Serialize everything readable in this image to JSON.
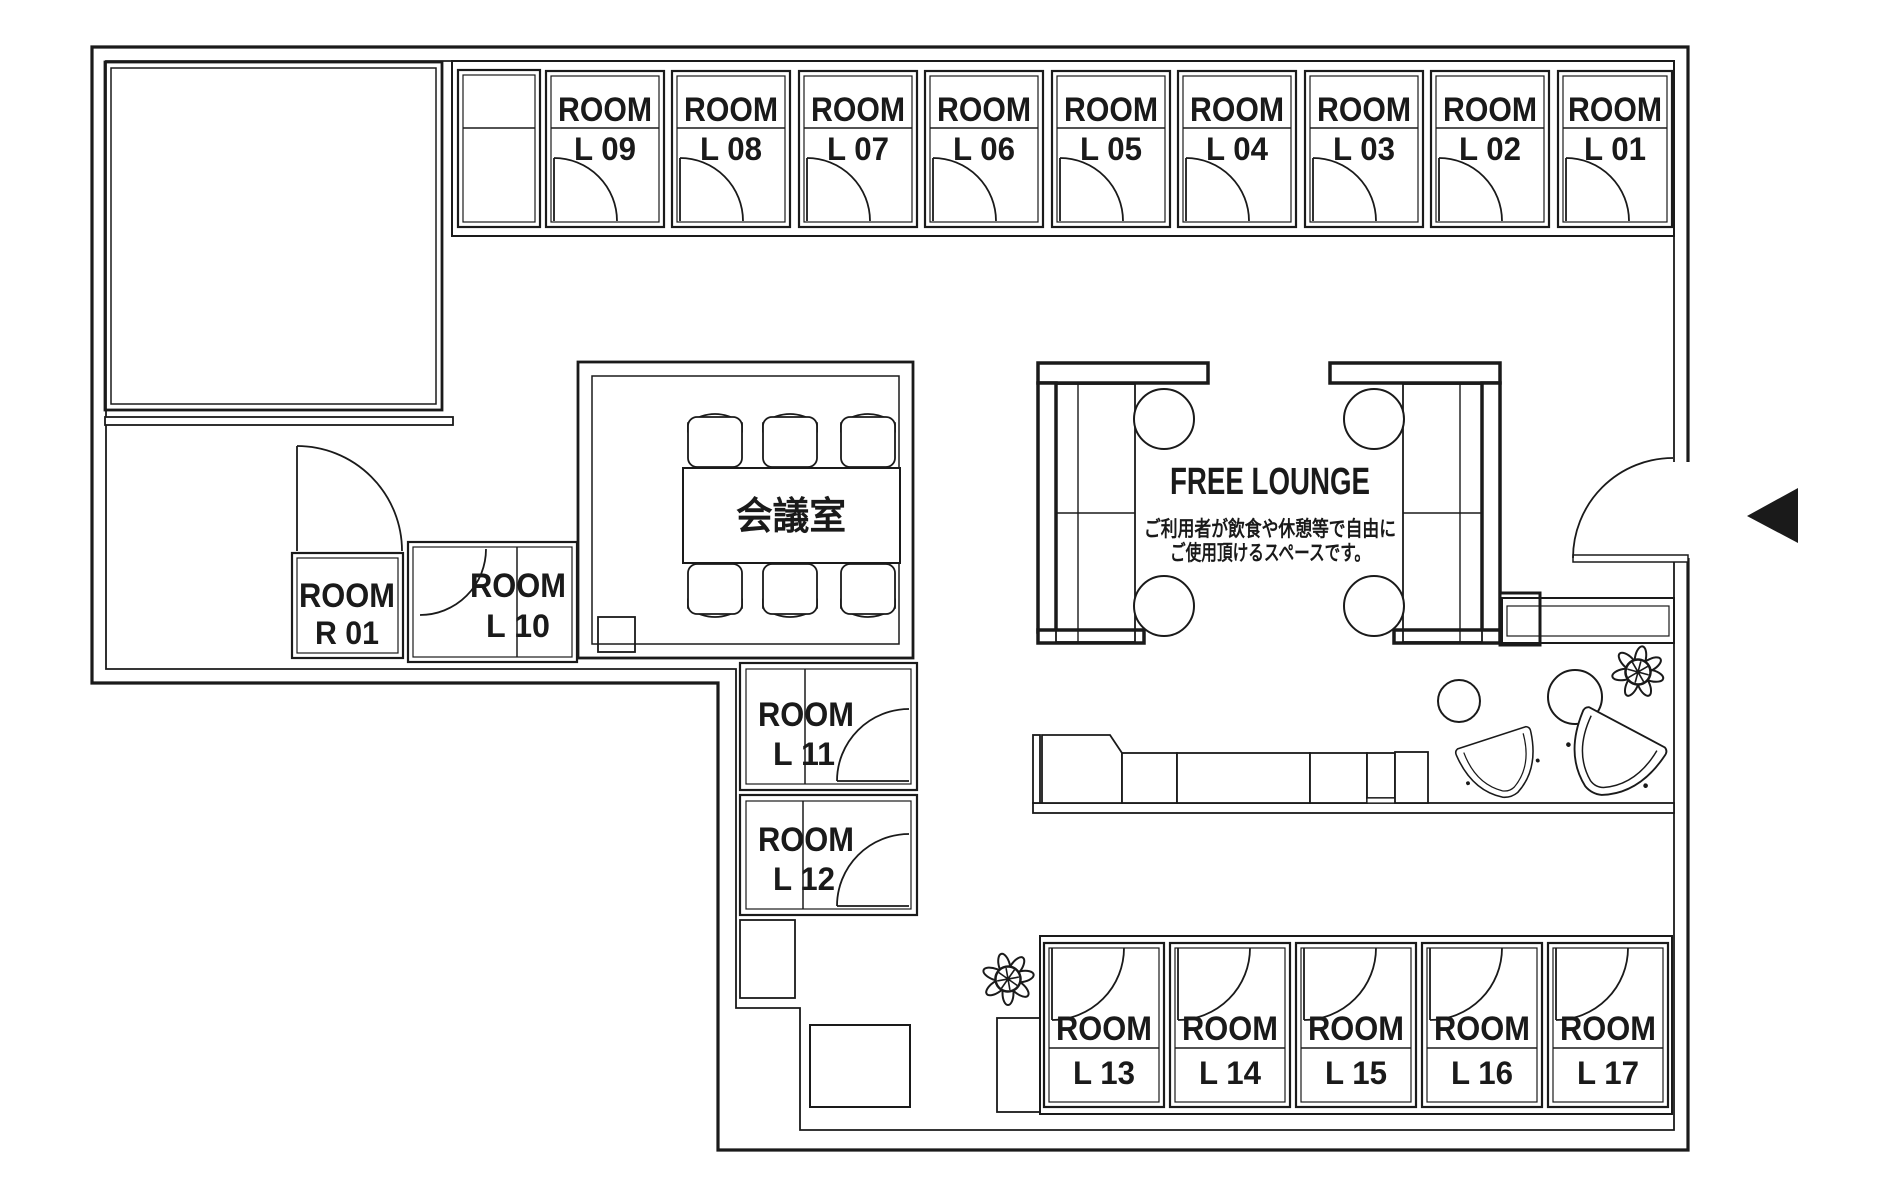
{
  "plan": {
    "colors": {
      "ink": "#1a1a1a",
      "accent_red": "#e60012",
      "background": "#ffffff"
    },
    "top_rooms": [
      {
        "label": "ROOM",
        "number": "L 09"
      },
      {
        "label": "ROOM",
        "number": "L 08"
      },
      {
        "label": "ROOM",
        "number": "L 07"
      },
      {
        "label": "ROOM",
        "number": "L 06"
      },
      {
        "label": "ROOM",
        "number": "L 05"
      },
      {
        "label": "ROOM",
        "number": "L 04"
      },
      {
        "label": "ROOM",
        "number": "L 03"
      },
      {
        "label": "ROOM",
        "number": "L 02"
      },
      {
        "label": "ROOM",
        "number": "L 01"
      }
    ],
    "bottom_rooms": [
      {
        "label": "ROOM",
        "number": "L 13"
      },
      {
        "label": "ROOM",
        "number": "L 14"
      },
      {
        "label": "ROOM",
        "number": "L 15"
      },
      {
        "label": "ROOM",
        "number": "L 16"
      },
      {
        "label": "ROOM",
        "number": "L 17"
      }
    ],
    "side_rooms": {
      "r01": {
        "label": "ROOM",
        "number": "R 01"
      },
      "l10": {
        "label": "ROOM",
        "number": "L 10"
      },
      "l11": {
        "label": "ROOM",
        "number": "L 11"
      },
      "l12": {
        "label": "ROOM",
        "number": "L 12"
      }
    },
    "meeting_room": {
      "label": "会議室"
    },
    "lounge": {
      "title": "FREE LOUNGE",
      "subtitle_line1": "ご利用者が飲食や休憩等で自由に",
      "subtitle_line2": "ご使用頂けるスペースです。",
      "accent_color": "#e60012"
    }
  }
}
